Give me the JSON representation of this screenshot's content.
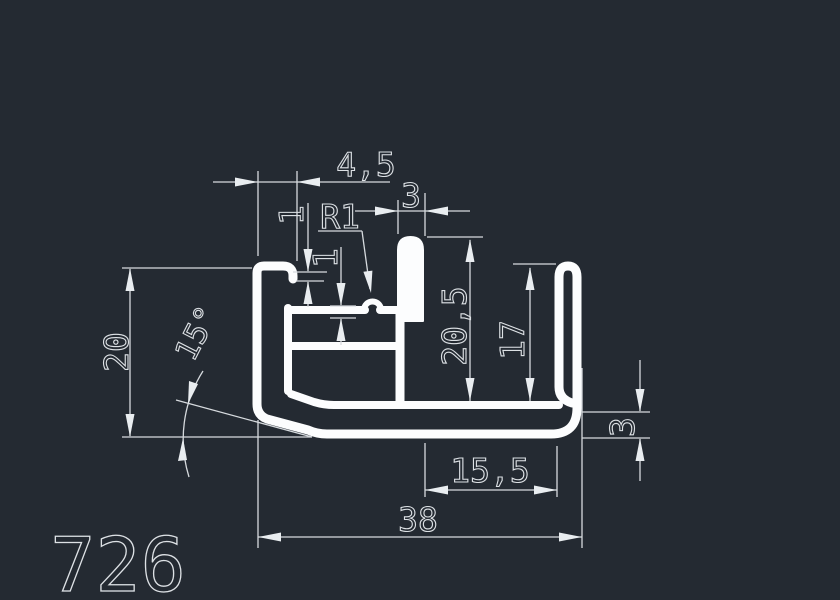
{
  "drawing": {
    "part_number": "726",
    "dimensions": {
      "top_width": "4,5",
      "stem_thickness": "3",
      "fillet_radius": "R1",
      "lip_gap": "1",
      "web_thickness": "1",
      "left_height": "20",
      "draft_angle": "15°",
      "channel_depth": "20,5",
      "hook_depth": "17",
      "base_thickness": "3",
      "channel_width": "15,5",
      "overall_width": "38"
    }
  },
  "colors": {
    "bg": "#242a32",
    "profile": "#fcfdfe",
    "dim": "#d6dade",
    "arrow": "#e9edf0",
    "text": "#dde1e5"
  }
}
